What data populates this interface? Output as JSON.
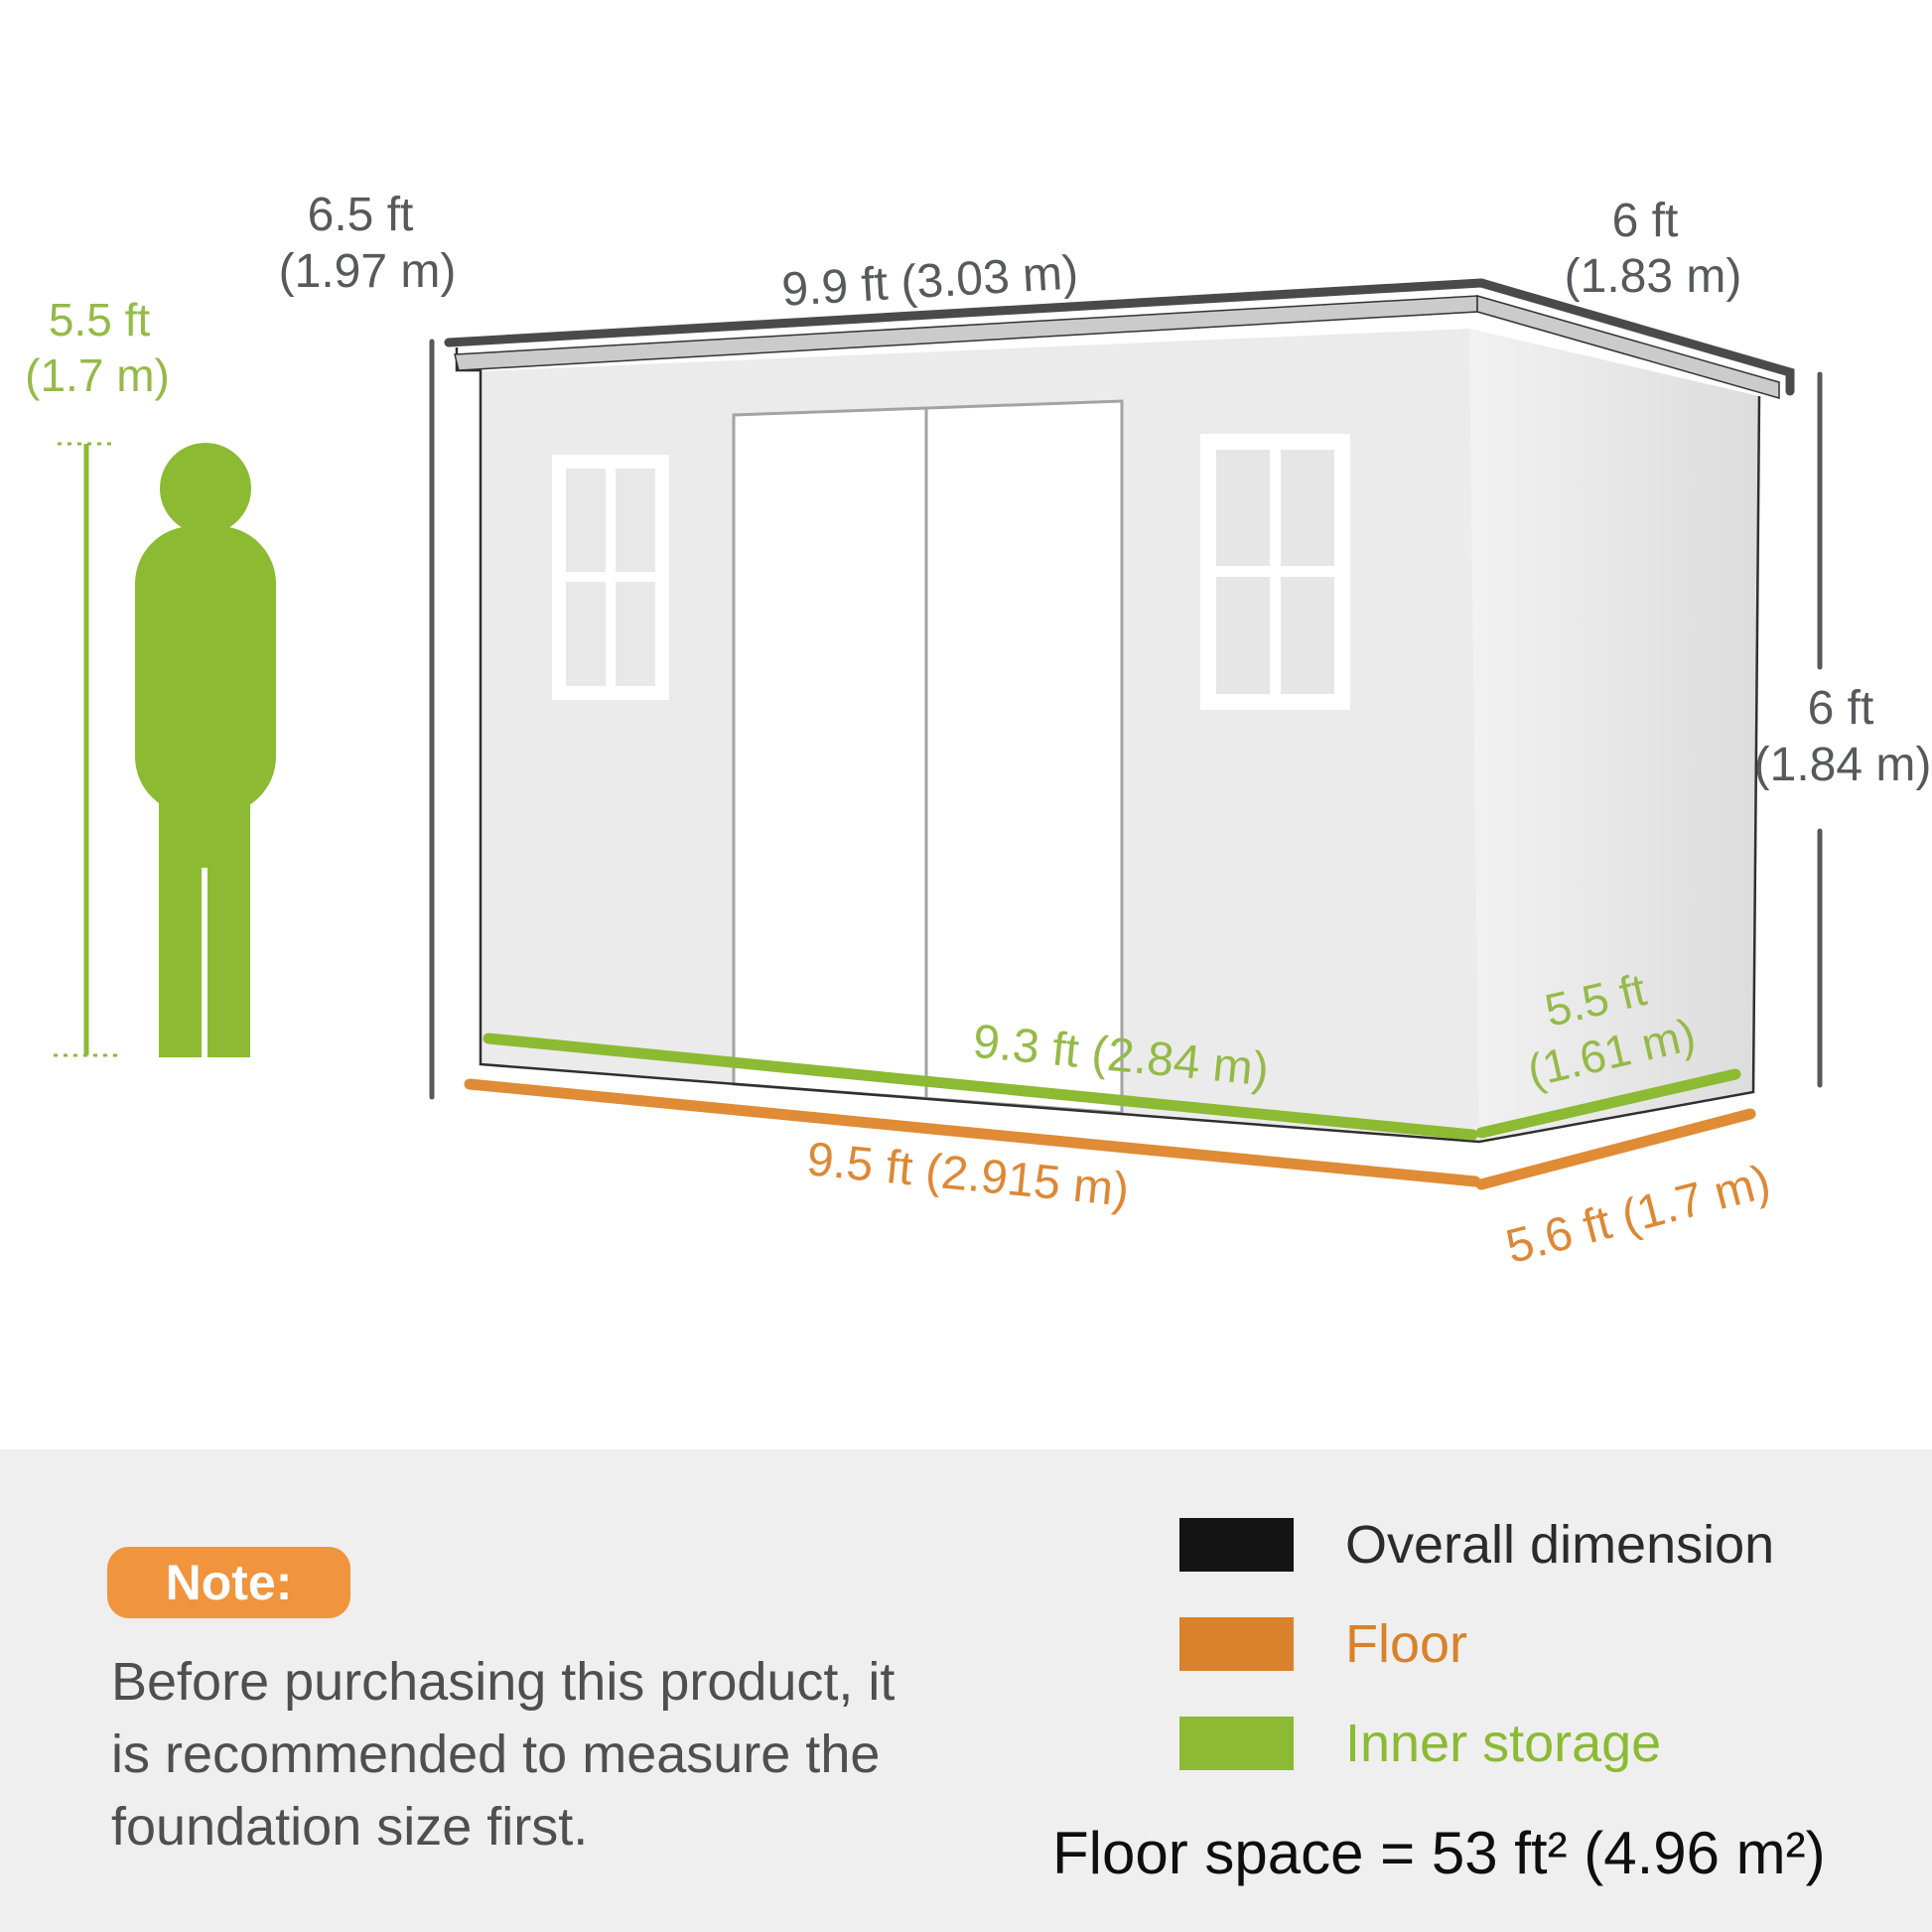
{
  "figure": {
    "height_line1": "5.5 ft",
    "height_line2": "(1.7 m)"
  },
  "dimensions": {
    "left_height": {
      "line1": "6.5 ft",
      "line2": "(1.97 m)"
    },
    "roof_front": "9.9 ft (3.03 m)",
    "roof_side": {
      "line1": "6 ft",
      "line2": "(1.83 m)"
    },
    "right_height": {
      "line1": "6 ft",
      "line2": "(1.84 m)"
    },
    "inner_front": "9.3 ft (2.84 m)",
    "inner_side": {
      "line1": "5.5 ft",
      "line2": "(1.61 m)"
    },
    "floor_front": "9.5 ft (2.915 m)",
    "floor_side": "5.6 ft (1.7 m)"
  },
  "note": {
    "badge": "Note:",
    "line1": "Before purchasing this product, it",
    "line2": "is recommended to measure the",
    "line3": "foundation size first."
  },
  "legend": {
    "items": [
      {
        "label": "Overall dimension",
        "color": "#141414"
      },
      {
        "label": "Floor",
        "color": "#d9822b"
      },
      {
        "label": "Inner storage",
        "color": "#8cba33"
      }
    ]
  },
  "floor_space": "Floor space = 53 ft² (4.96 m²)",
  "colors": {
    "inner_storage_green": "#8cba33",
    "floor_orange": "#e08b35",
    "dimension_gray": "#58595b",
    "note_badge_orange": "#f0943d",
    "section_background": "#efefef"
  }
}
